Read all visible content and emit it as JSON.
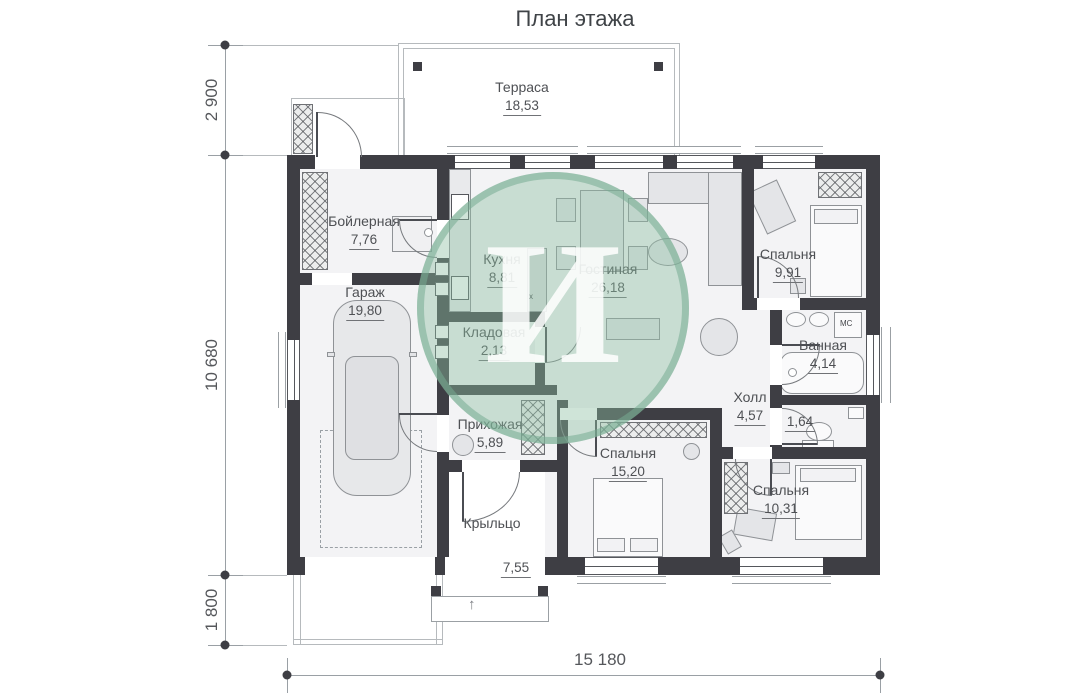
{
  "title": "План этажа",
  "watermark": {
    "letter": "И"
  },
  "rooms": [
    {
      "id": "terrace",
      "name": "Терраса",
      "area": "18,53"
    },
    {
      "id": "boiler",
      "name": "Бойлерная",
      "area": "7,76"
    },
    {
      "id": "garage",
      "name": "Гараж",
      "area": "19,80"
    },
    {
      "id": "kitchen",
      "name": "Кухня",
      "area": "8,81"
    },
    {
      "id": "living",
      "name": "Гостиная",
      "area": "26,18"
    },
    {
      "id": "storage",
      "name": "Кладовая",
      "area": "2,13"
    },
    {
      "id": "hallway",
      "name": "Прихожая",
      "area": "5,89"
    },
    {
      "id": "porch",
      "name": "Крыльцо",
      "area": "7,55"
    },
    {
      "id": "bedroom1",
      "name": "Спальня",
      "area": "9,91"
    },
    {
      "id": "bathroom",
      "name": "Ванная",
      "area": "4,14"
    },
    {
      "id": "hall",
      "name": "Холл",
      "area": "4,57"
    },
    {
      "id": "wc",
      "name": "",
      "area": "1,64"
    },
    {
      "id": "bedroom2",
      "name": "Спальня",
      "area": "15,20"
    },
    {
      "id": "bedroom3",
      "name": "Спальня",
      "area": "10,31"
    }
  ],
  "dimensions": {
    "left": [
      "2 900",
      "10 680",
      "1 800"
    ],
    "bottom": [
      "15 180"
    ]
  },
  "annotations": {
    "washing_machine": "МС",
    "bar_stool": "х"
  }
}
